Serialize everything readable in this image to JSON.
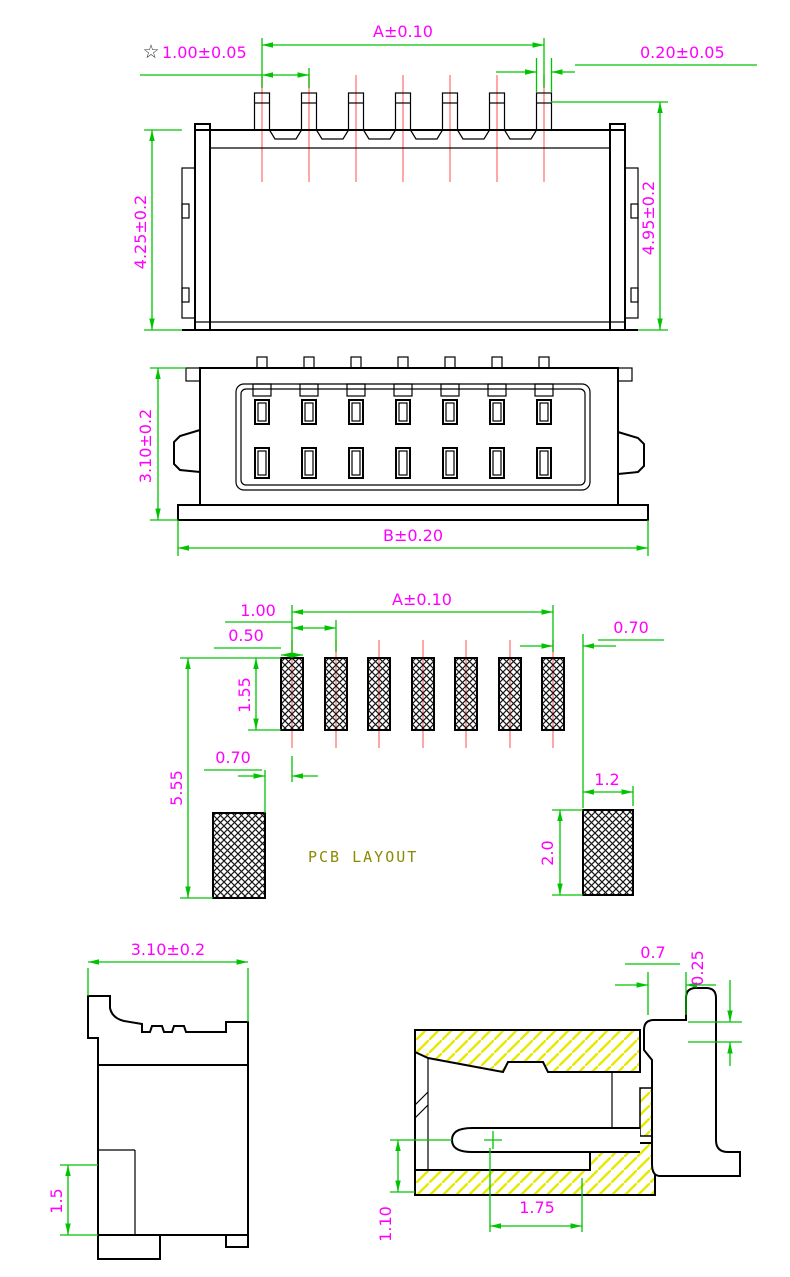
{
  "drawing_title": "SMT wafer connector engineering drawing",
  "colors": {
    "dimension_line": "#00c400",
    "dimension_text": "#ff00ff",
    "outline": "#000000",
    "pin_centerline": "#ff8080",
    "section_hatch": "#e8e800",
    "pcb_label_text": "#8b8b00"
  },
  "front_view": {
    "dim_pitch_span": "A±0.10",
    "dim_pitch_star": "☆",
    "dim_pitch": "1.00±0.05",
    "dim_pin_width": "0.20±0.05",
    "dim_body_height": "4.25±0.2",
    "dim_overall_height": "4.95±0.2"
  },
  "plan_view": {
    "dim_depth": "3.10±0.2",
    "dim_overall_width": "B±0.20"
  },
  "pcb_layout": {
    "label": "PCB LAYOUT",
    "dim_pad_span": "A±0.10",
    "dim_pitch": "1.00",
    "dim_pad_width": "0.50",
    "dim_right_gap": "0.70",
    "dim_pad_length": "1.55",
    "dim_overall_length": "5.55",
    "dim_left_gap": "0.70",
    "dim_anchor_width": "1.2",
    "dim_anchor_height": "2.0"
  },
  "side_view": {
    "dim_width": "3.10±0.2",
    "dim_standoff": "1.5"
  },
  "section_view": {
    "dim_top_gap": "0.7",
    "dim_lead_thickness": "0.25",
    "dim_cavity_height": "1.10",
    "dim_contact_depth": "1.75"
  }
}
